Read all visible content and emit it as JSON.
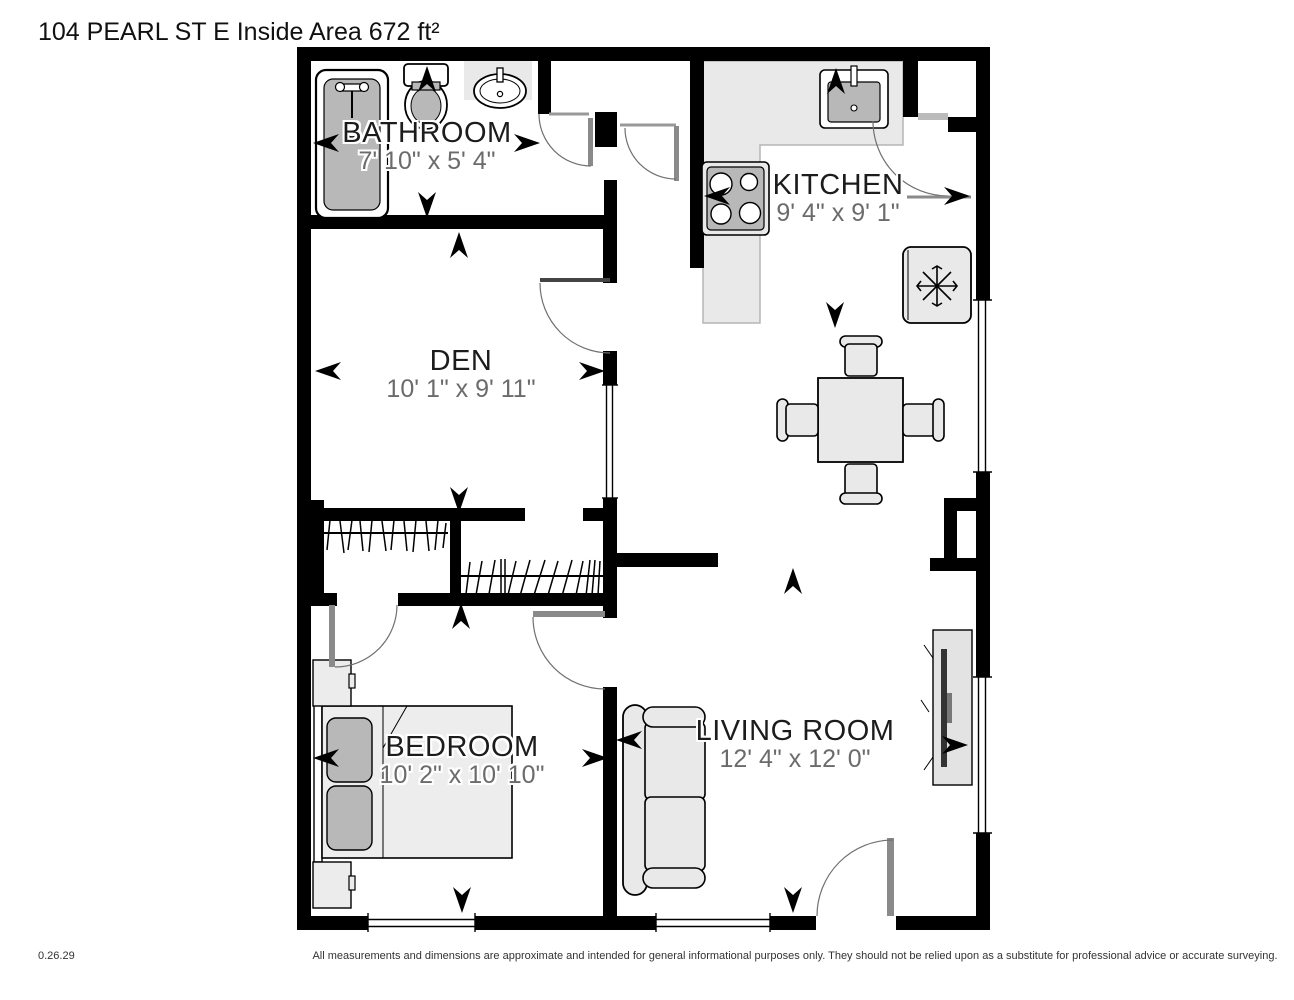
{
  "title": "104 PEARL ST E Inside Area 672 ft²",
  "rooms": {
    "bathroom": {
      "name": "BATHROOM",
      "dims": "7' 10\" x 5' 4\""
    },
    "kitchen": {
      "name": "KITCHEN",
      "dims": "9' 4\" x 9' 1\""
    },
    "den": {
      "name": "DEN",
      "dims": "10' 1\" x 9' 11\""
    },
    "bedroom": {
      "name": "BEDROOM",
      "dims": "10' 2\" x 10' 10\""
    },
    "living_room": {
      "name": "LIVING ROOM",
      "dims": "12' 4\" x 12' 0\""
    }
  },
  "footer": {
    "version": "0.26.29",
    "disclaimer": "All measurements and dimensions are approximate and intended for general informational purposes only. They should not be relied upon as a substitute for professional advice or accurate surveying."
  },
  "colors": {
    "wall": "#000000",
    "counter": "#e9e9e9",
    "furniture_light": "#e9e9e9",
    "furniture_mid": "#b8b8b8",
    "room_name_text": "#1c1c1c",
    "dims_text": "#6b6b6b",
    "door_panel": "#8a8a8a"
  }
}
